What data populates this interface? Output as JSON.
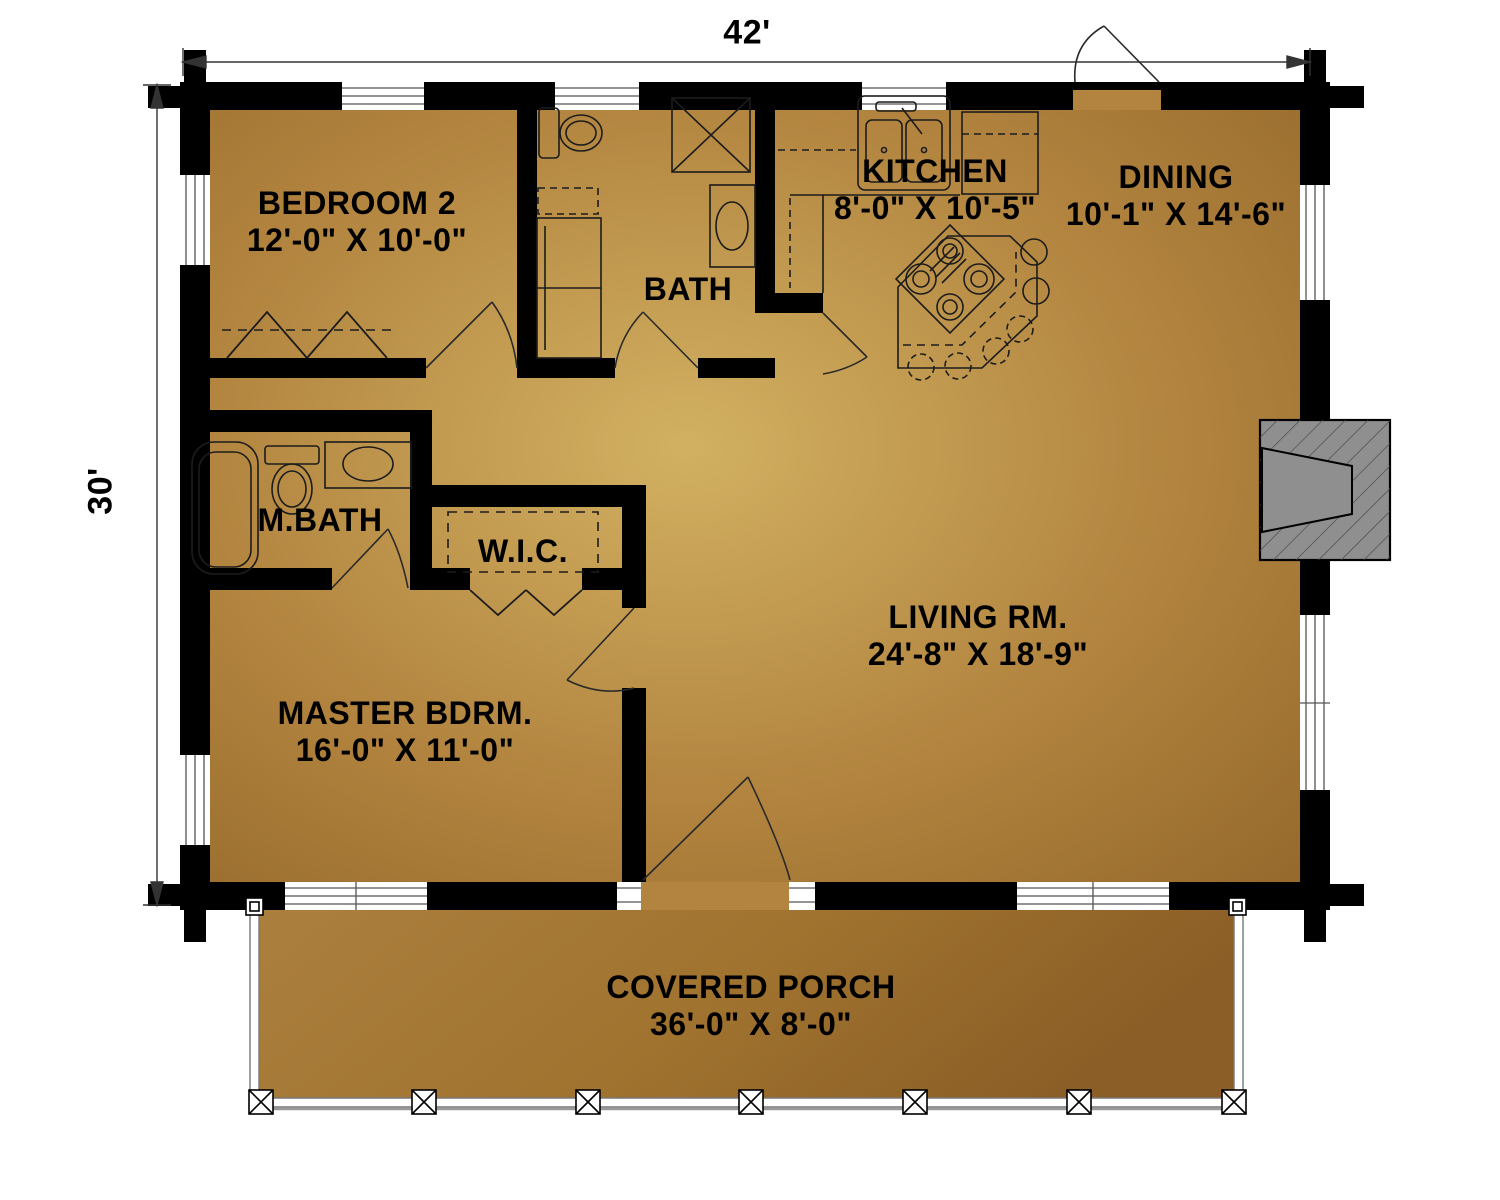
{
  "plan": {
    "type": "single-story log home floor plan",
    "overall_width_label": "42'",
    "overall_height_label": "30'"
  },
  "rooms": {
    "bedroom2": {
      "name": "BEDROOM 2",
      "dims": "12'-0\" X 10'-0\""
    },
    "bath": {
      "name": "BATH",
      "dims": ""
    },
    "kitchen": {
      "name": "KITCHEN",
      "dims": "8'-0\" X 10'-5\""
    },
    "dining": {
      "name": "DINING",
      "dims": "10'-1\" X 14'-6\""
    },
    "master_bath": {
      "name": "M.BATH",
      "dims": ""
    },
    "wic": {
      "name": "W.I.C.",
      "dims": ""
    },
    "living": {
      "name": "LIVING RM.",
      "dims": "24'-8\" X 18'-9\""
    },
    "master_bedroom": {
      "name": "MASTER BDRM.",
      "dims": "16'-0\" X 11'-0\""
    },
    "porch": {
      "name": "COVERED PORCH",
      "dims": "36'-0\" X 8'-0\""
    }
  },
  "fixtures": {
    "kitchen": [
      "double-sink",
      "refrigerator",
      "island-cooktop",
      "bar-stools"
    ],
    "bath": [
      "toilet",
      "shower",
      "washer-dryer",
      "vanity-sink"
    ],
    "master_bath": [
      "bathtub",
      "toilet",
      "vanity-sink"
    ],
    "living": [
      "fireplace"
    ],
    "wic": [
      "closet-rod"
    ],
    "bedroom2": [
      "bifold-closet"
    ],
    "porch": [
      "railing",
      "posts"
    ]
  },
  "colors": {
    "wall": "#000000",
    "text": "#000000",
    "background": "#ffffff",
    "floor_light": "#d2b162",
    "floor_mid": "#b2843f",
    "floor_dark": "#8c6126",
    "fireplace": "#8f8f8f"
  }
}
